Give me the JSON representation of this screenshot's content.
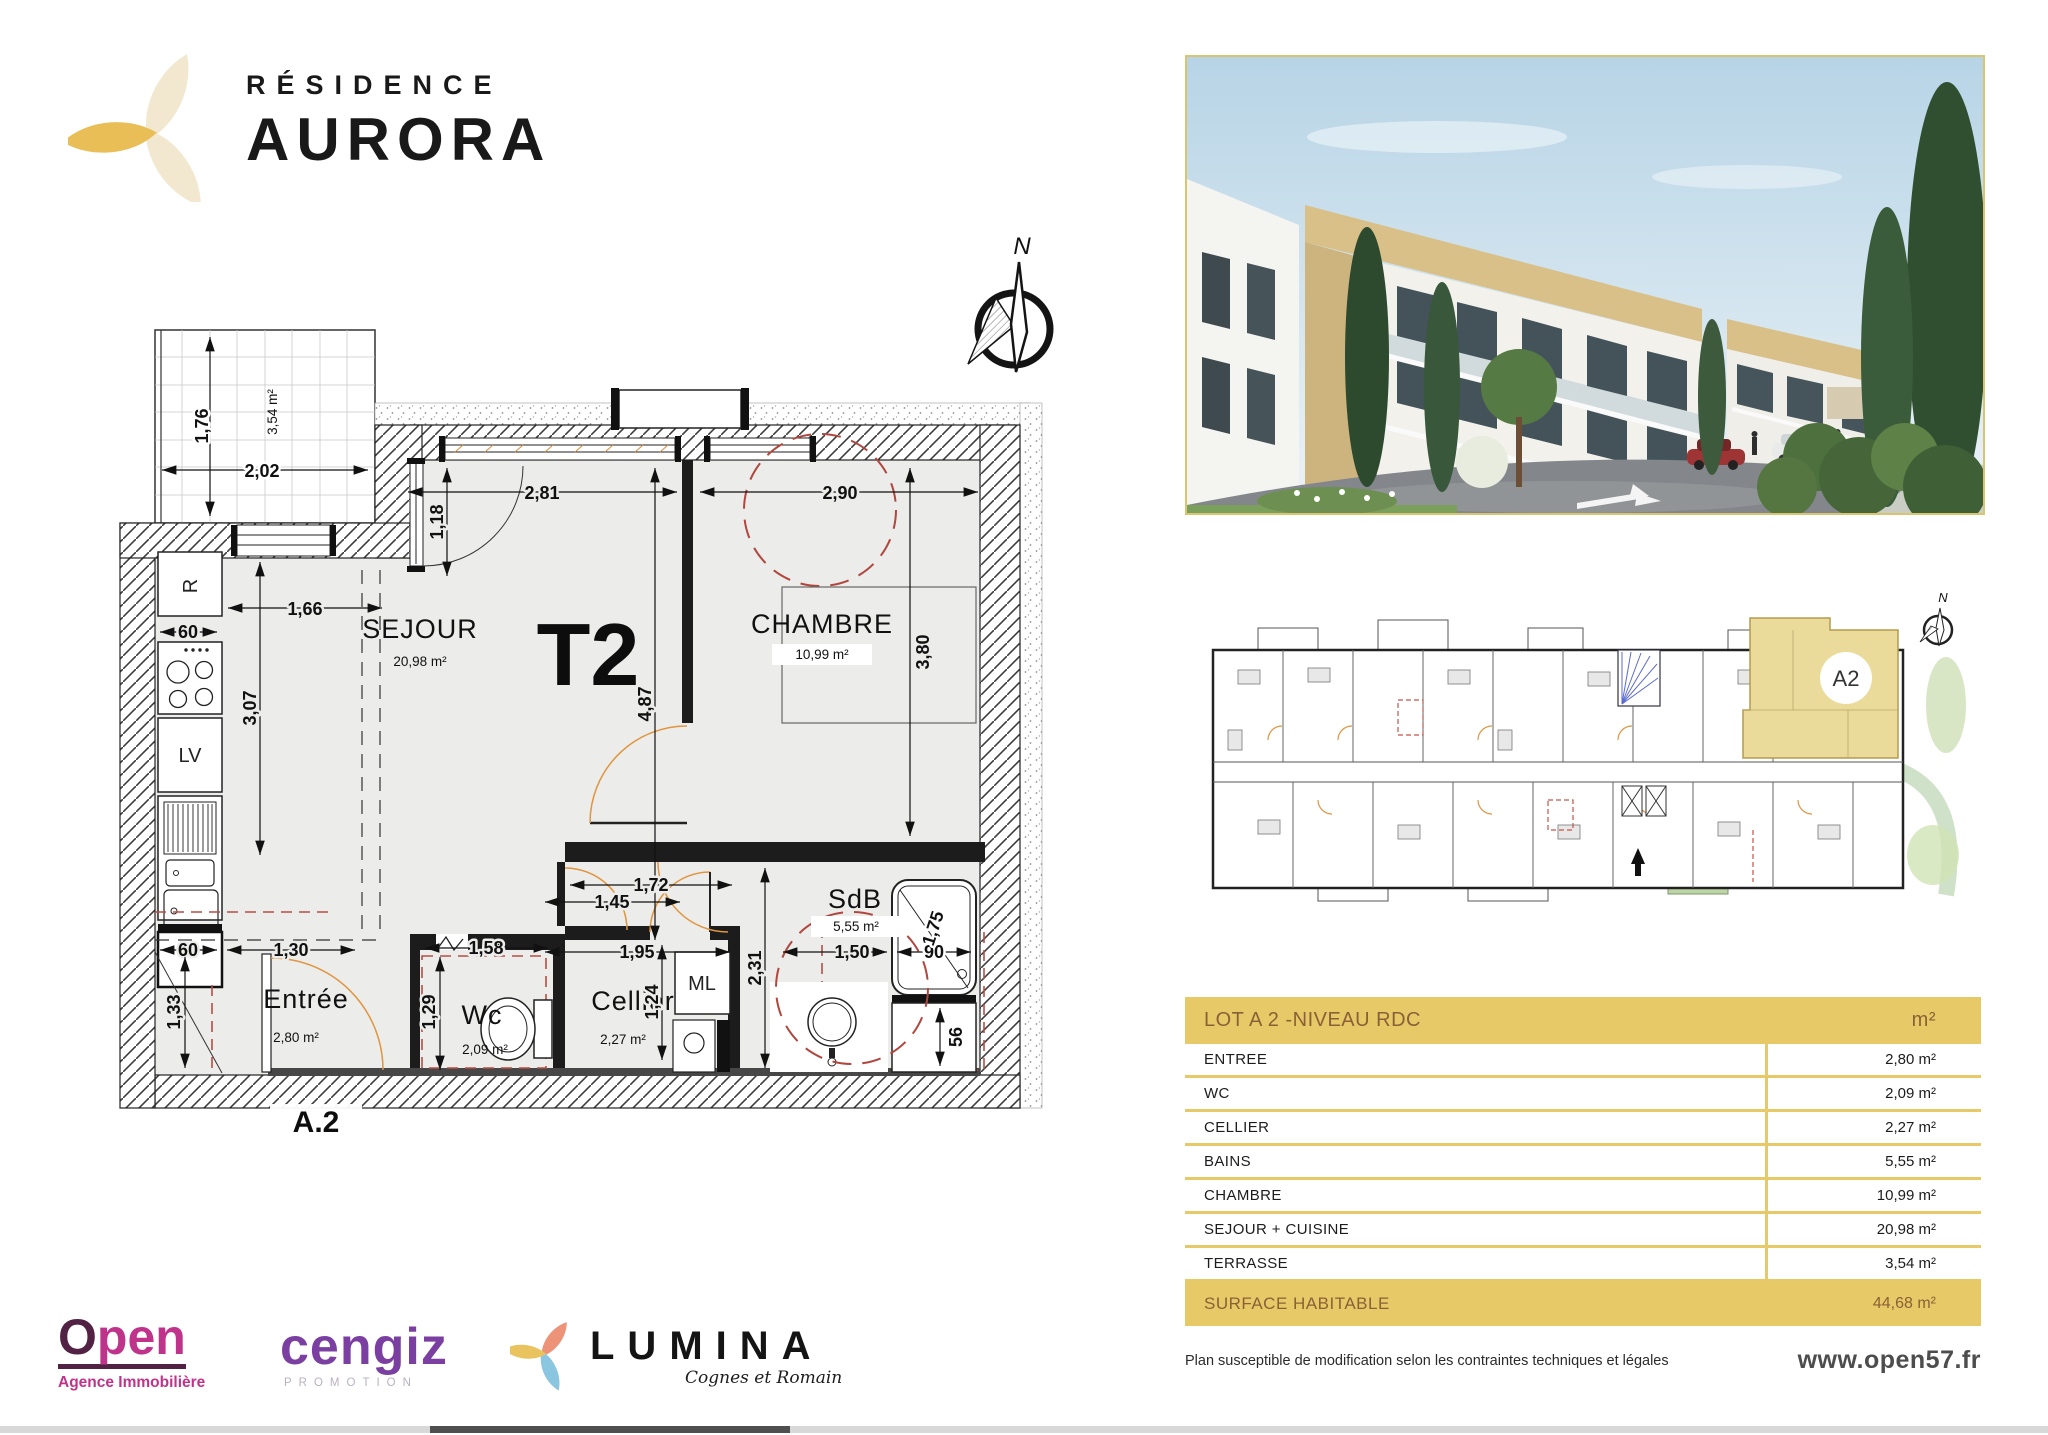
{
  "branding": {
    "residence_label": "RÉSIDENCE",
    "residence_name": "AURORA"
  },
  "compass": {
    "north_label": "N"
  },
  "plan": {
    "unit_type": "T2",
    "unit_label": "A.2",
    "rooms": {
      "sejour": {
        "name": "SEJOUR",
        "area": "20,98 m²"
      },
      "chambre": {
        "name": "CHAMBRE",
        "area": "10,99 m²"
      },
      "sdb": {
        "name": "SdB",
        "area": "5,55 m²"
      },
      "entree": {
        "name": "Entrée",
        "area": "2,80 m²"
      },
      "wc": {
        "name": "Wc",
        "area": "2,09 m²"
      },
      "cellier": {
        "name": "Cellier",
        "area": "2,27 m²"
      },
      "terrasse": {
        "area": "3,54 m²"
      }
    },
    "appliances": {
      "fridge": "R",
      "dishwasher": "LV",
      "washing_machine": "ML"
    },
    "dims": {
      "d202": "2,02",
      "d176": "1,76",
      "d118": "1,18",
      "d281": "2,81",
      "d290": "2,90",
      "d166": "1,66",
      "d307": "3,07",
      "d487": "4,87",
      "d380": "3,80",
      "d60a": "60",
      "d60b": "60",
      "d130": "1,30",
      "d133": "1,33",
      "d158": "1,58",
      "d129": "1,29",
      "d172": "1,72",
      "d145": "1,45",
      "d195": "1,95",
      "d124": "1,24",
      "d231": "2,31",
      "d150": "1,50",
      "d175": "1,75",
      "d90": "90",
      "d56": "56"
    }
  },
  "siteplan": {
    "highlight_label": "A2",
    "north_label": "N"
  },
  "table": {
    "title": "LOT A 2 -NIVEAU RDC",
    "unit_header": "m²",
    "rows": [
      {
        "label": "ENTREE",
        "value": "2,80 m²"
      },
      {
        "label": "WC",
        "value": "2,09 m²"
      },
      {
        "label": "CELLIER",
        "value": "2,27 m²"
      },
      {
        "label": "BAINS",
        "value": "5,55 m²"
      },
      {
        "label": "CHAMBRE",
        "value": "10,99 m²"
      },
      {
        "label": "SEJOUR + CUISINE",
        "value": "20,98 m²"
      },
      {
        "label": "TERRASSE",
        "value": "3,54 m²"
      }
    ],
    "footer": {
      "label": "SURFACE HABITABLE",
      "value": "44,68 m²"
    }
  },
  "footer": {
    "disclaimer": "Plan susceptible de modification selon les contraintes techniques et légales",
    "website": "www.open57.fr"
  },
  "partners": {
    "open": {
      "name_initial": "O",
      "name_rest": "pen",
      "tagline": "Agence Immobilière"
    },
    "cengiz": {
      "name": "cengiz",
      "tagline": "PROMOTION"
    },
    "lumina": {
      "name": "LUMINA",
      "tagline": "Cognes et Romain"
    }
  },
  "colors": {
    "gold": "#e8c968",
    "table_text_brown": "#8a6137",
    "plan_floor": "#ececea",
    "red_dash": "#b0473f",
    "door_orange": "#e0953f",
    "open_magenta": "#c0338b",
    "open_plum": "#512244",
    "cengiz_purple": "#7b3fa2",
    "lumina_salmon": "#ec9378",
    "lumina_gold": "#e9c35e",
    "lumina_blue": "#8ac6e0",
    "logo_cream": "#f2e8cf",
    "logo_gold": "#e9be57"
  }
}
